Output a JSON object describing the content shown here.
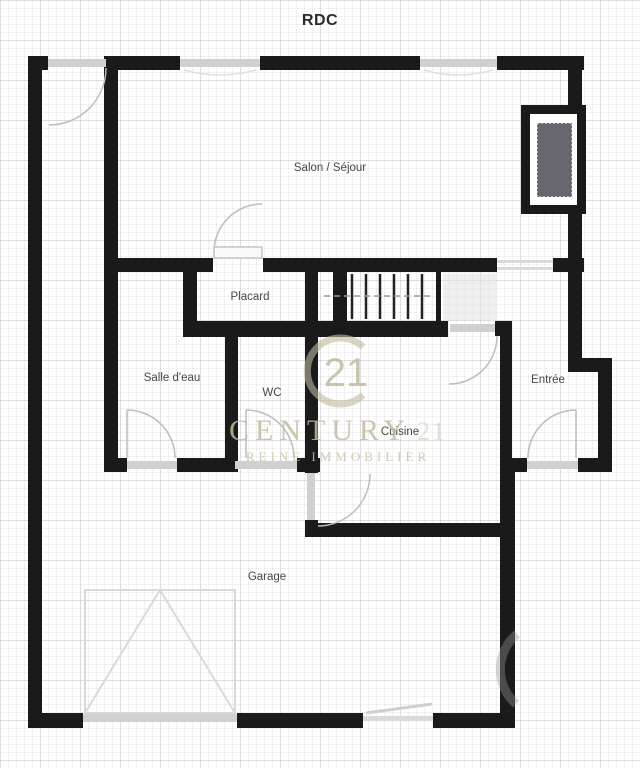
{
  "title": "RDC",
  "rooms": {
    "salon": "Salon / Séjour",
    "placard": "Placard",
    "salle_deau": "Salle d'eau",
    "wc": "WC",
    "cuisine": "Cuisine",
    "entree": "Entrée",
    "garage": "Garage"
  },
  "watermark": {
    "logo_number": "21",
    "brand": "CENTURY",
    "brand_number": "21",
    "tagline": "REINE IMMOBILIER"
  },
  "colors": {
    "wall": "#1a1a1a",
    "opening_sill": "#d0d0d0",
    "door_swing": "#bdbdbd",
    "chimney_fill": "#67666e",
    "watermark": "#c4ba9c"
  }
}
